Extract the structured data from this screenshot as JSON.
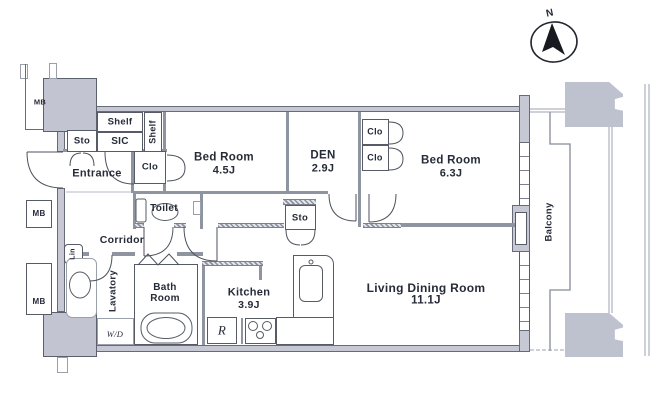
{
  "palette": {
    "wall_fill": "#c6c9d4",
    "wall_edge": "#676b77",
    "thin_wall": "#8f94a1",
    "line": "#7d8290",
    "text": "#262b38",
    "bg": "#ffffff"
  },
  "compass": {
    "label": "N"
  },
  "labels": {
    "mb_top": "MB",
    "mb_middle": "MB",
    "mb_bottom": "MB",
    "shelf_top": "Shelf",
    "shelf_side": "Shelf",
    "sic": "SIC",
    "sto_entrance": "Sto",
    "entrance": "Entrance",
    "clo_entrance": "Clo",
    "toilet": "Toilet",
    "corridor": "Corridor",
    "sto_hall": "Sto",
    "lin": "Lin",
    "lavatory": "Lavatory",
    "washer_dryer": "W/D",
    "clo_upper": "Clo",
    "clo_lower": "Clo",
    "fridge": "R",
    "balcony": "Balcony"
  },
  "rooms": {
    "bedroom1": {
      "name": "Bed Room",
      "size": "4.5J"
    },
    "den": {
      "name": "DEN",
      "size": "2.9J"
    },
    "bedroom2": {
      "name": "Bed Room",
      "size": "6.3J"
    },
    "bathroom": {
      "line1": "Bath",
      "line2": "Room"
    },
    "kitchen": {
      "name": "Kitchen",
      "size": "3.9J"
    },
    "living": {
      "name": "Living Dining Room",
      "size": "11.1J"
    }
  }
}
